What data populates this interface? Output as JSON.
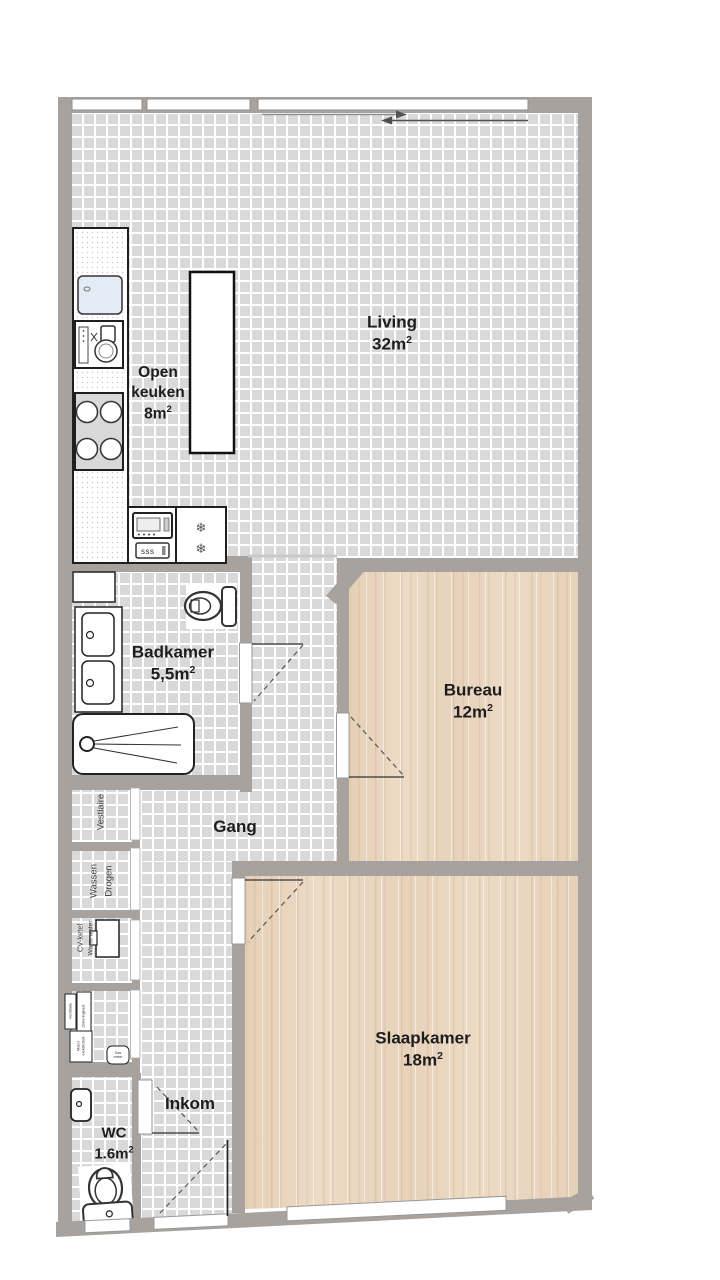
{
  "plan": {
    "sup": "2",
    "rooms": {
      "living": {
        "name": "Living",
        "area": "32m"
      },
      "open_keuken": {
        "name_line1": "Open",
        "name_line2": "keuken",
        "area": "8m"
      },
      "badkamer": {
        "name": "Badkamer",
        "area": "5,5m"
      },
      "bureau": {
        "name": "Bureau",
        "area": "12m"
      },
      "gang": {
        "name": "Gang"
      },
      "slaapkamer": {
        "name": "Slaapkamer",
        "area": "18m"
      },
      "inkom": {
        "name": "Inkom"
      },
      "wc": {
        "name": "WC",
        "area": "1.6m"
      }
    },
    "closets": {
      "vestiaire": "Vestiaire",
      "wassen_line1": "Wassen",
      "wassen_line2": "Drogen",
      "cv_line1": "CV-ketel",
      "cv_line2": "Warm water"
    },
    "meters": {
      "box1": "Ventilatie",
      "box2": "Zekeringkast",
      "box3_line1": "Meter",
      "box3_line2": "elektriciteit",
      "box4_line1": "Gas",
      "box4_line2": "meter"
    },
    "fixtures": {
      "oven_label": "sss"
    },
    "icons": {
      "snowflake": "❄"
    },
    "colors": {
      "wall": "#a7a29e",
      "tile_fill": "#d9d9d9",
      "tile_grout": "#ffffff",
      "wood": "#eddbc6",
      "sink_blue": "#e3ebf5"
    }
  }
}
